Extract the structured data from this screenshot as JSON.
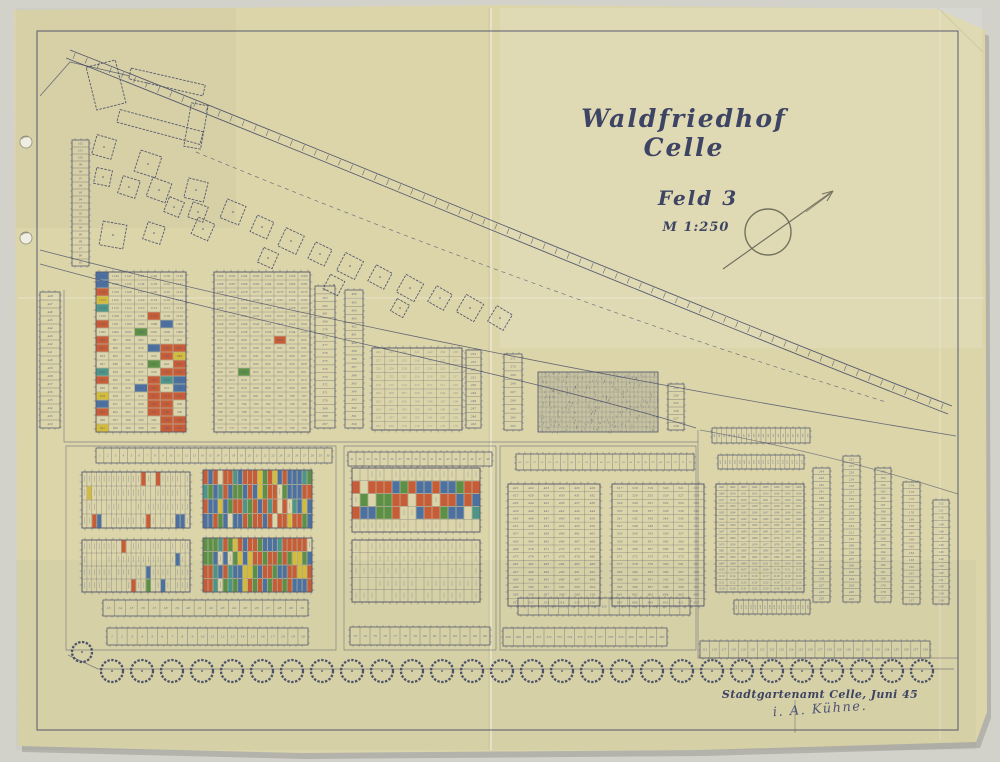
{
  "title_block": {
    "title": "Waldfriedhof Celle",
    "subtitle": "Feld 3",
    "scale": "M 1:250"
  },
  "stamp": {
    "office_line": "Stadtgartenamt Celle, Juni 45",
    "signature": "i. A. Kühne."
  },
  "colors": {
    "photo_bg": "#d2d2cb",
    "paper": "#dcd5aa",
    "ink": "#3e4463",
    "ink_light": "#555d82",
    "signature_ink": "#4e5576",
    "compass_ink": "#73725f",
    "plot_palette": [
      "#c4512c",
      "#3f68a0",
      "#4f8a3d",
      "#d1b832",
      "#3f8f86"
    ]
  },
  "north_arrow": {
    "cx": 768,
    "cy": 232,
    "r": 23
  },
  "map": {
    "roads": {
      "main_top": "M70,50 C350,160 650,288 952,406",
      "main_bot": "M66,58 C346,168 646,296 948,414",
      "dashed": "M196,152 C420,245 660,332 886,402",
      "curve1": "M40,250 C300,318 640,384 956,436",
      "curve2": "M40,264 C280,330 520,374 696,428",
      "spur": "M40,96 L70,62 L130,76",
      "fr_diag": "M700,430 C790,446 876,468 958,494"
    },
    "outlines": [
      "M64,290 V442 H698",
      "M66,446 H336 V650 H66 Z",
      "M344,446 H496 V650 H344 Z",
      "M500,446 H696 V650 H500 Z",
      "M698,430 V658 H958",
      "M795,700 V733"
    ],
    "buildings": {
      "bars": [
        [
          167,
          82,
          76,
          11,
          13
        ],
        [
          160,
          127,
          86,
          13,
          15
        ],
        [
          196,
          126,
          17,
          44,
          10
        ],
        [
          106,
          85,
          30,
          44,
          -14
        ]
      ],
      "squares": [
        [
          104,
          147,
          20,
          16
        ],
        [
          148,
          164,
          22,
          18
        ],
        [
          103,
          177,
          16,
          12
        ],
        [
          129,
          187,
          18,
          18
        ],
        [
          159,
          190,
          20,
          20
        ],
        [
          174,
          207,
          16,
          22
        ],
        [
          196,
          190,
          20,
          14
        ],
        [
          198,
          212,
          16,
          20
        ],
        [
          203,
          229,
          18,
          24
        ],
        [
          113,
          235,
          24,
          10
        ],
        [
          154,
          233,
          18,
          18
        ],
        [
          233,
          212,
          20,
          22
        ],
        [
          262,
          227,
          18,
          24
        ],
        [
          291,
          241,
          20,
          25
        ],
        [
          320,
          254,
          18,
          26
        ],
        [
          350,
          266,
          20,
          27
        ],
        [
          380,
          277,
          18,
          28
        ],
        [
          410,
          288,
          20,
          29
        ],
        [
          440,
          298,
          18,
          30
        ],
        [
          470,
          308,
          20,
          30
        ],
        [
          500,
          318,
          18,
          31
        ],
        [
          268,
          258,
          16,
          24
        ],
        [
          334,
          285,
          16,
          27
        ],
        [
          400,
          308,
          14,
          29
        ]
      ]
    },
    "strips": [
      {
        "id": "cluster-col",
        "x": 72,
        "y": 140,
        "len": 126,
        "cells": 18,
        "dir": "v",
        "w": 17,
        "start": 102,
        "step": -1,
        "fs": 2.6
      },
      {
        "id": "V1",
        "x": 40,
        "y": 292,
        "len": 136,
        "cells": 17,
        "dir": "v",
        "w": 20,
        "start": 448,
        "step": -1,
        "fs": 2.8
      },
      {
        "id": "V2",
        "x": 315,
        "y": 286,
        "len": 142,
        "cells": 18,
        "dir": "v",
        "w": 20,
        "start": 384,
        "step": -1,
        "fs": 2.8
      },
      {
        "id": "V3",
        "x": 345,
        "y": 290,
        "len": 138,
        "cells": 17,
        "dir": "v",
        "w": 18,
        "start": 406,
        "step": -1,
        "fs": 2.8
      },
      {
        "id": "V4",
        "x": 466,
        "y": 350,
        "len": 78,
        "cells": 10,
        "dir": "v",
        "w": 15,
        "start": 254,
        "step": -1,
        "fs": 2.8
      },
      {
        "id": "V5",
        "x": 504,
        "y": 354,
        "len": 76,
        "cells": 9,
        "dir": "v",
        "w": 18,
        "start": 271,
        "step": -1,
        "fs": 2.8
      },
      {
        "id": "V6",
        "x": 668,
        "y": 384,
        "len": 46,
        "cells": 6,
        "dir": "v",
        "w": 16,
        "start": 233,
        "step": 1,
        "fs": 2.8
      },
      {
        "id": "S1",
        "x": 813,
        "y": 468,
        "len": 134,
        "cells": 20,
        "dir": "v",
        "w": 17,
        "start": 244,
        "step": -1,
        "fs": 2.8
      },
      {
        "id": "S2",
        "x": 843,
        "y": 456,
        "len": 146,
        "cells": 22,
        "dir": "v",
        "w": 17,
        "start": 222,
        "step": -1,
        "fs": 2.8
      },
      {
        "id": "S3",
        "x": 875,
        "y": 468,
        "len": 134,
        "cells": 20,
        "dir": "v",
        "w": 16,
        "start": 196,
        "step": -1,
        "fs": 2.8
      },
      {
        "id": "S4",
        "x": 903,
        "y": 482,
        "len": 122,
        "cells": 18,
        "dir": "v",
        "w": 17,
        "start": 174,
        "step": -1,
        "fs": 2.8
      },
      {
        "id": "S5",
        "x": 933,
        "y": 500,
        "len": 104,
        "cells": 15,
        "dir": "v",
        "w": 16,
        "start": 152,
        "step": -1,
        "fs": 2.8
      },
      {
        "id": "L-top",
        "x": 96,
        "y": 448,
        "len": 236,
        "cells": 30,
        "dir": "h",
        "w": 15,
        "start": 1,
        "step": 1,
        "fs": 2.4
      },
      {
        "id": "M-top",
        "x": 348,
        "y": 452,
        "len": 144,
        "cells": 18,
        "dir": "h",
        "w": 14,
        "start": 31,
        "step": 1,
        "fs": 2.4
      },
      {
        "id": "R-top",
        "x": 516,
        "y": 454,
        "len": 178,
        "cells": 24,
        "dir": "h",
        "w": 16,
        "start": 49,
        "step": 1,
        "fs": 2.2
      },
      {
        "id": "FR-top1",
        "x": 712,
        "y": 428,
        "len": 98,
        "cells": 20,
        "dir": "h",
        "w": 15,
        "start": 481,
        "step": 1,
        "fs": 2.0,
        "rot": true
      },
      {
        "id": "FR-top2",
        "x": 718,
        "y": 455,
        "len": 86,
        "cells": 18,
        "dir": "h",
        "w": 14,
        "start": 461,
        "step": 1,
        "fs": 2.0,
        "rot": true
      },
      {
        "id": "FR-grid-bottom",
        "x": 734,
        "y": 600,
        "len": 76,
        "cells": 16,
        "dir": "h",
        "w": 14,
        "start": 441,
        "step": 1,
        "fs": 2.0,
        "rot": true
      },
      {
        "id": "BL1",
        "x": 103,
        "y": 600,
        "len": 205,
        "cells": 18,
        "dir": "h",
        "w": 16,
        "start": 13,
        "step": 1,
        "fs": 3
      },
      {
        "id": "BL2",
        "x": 107,
        "y": 628,
        "len": 201,
        "cells": 20,
        "dir": "h",
        "w": 17,
        "start": 1,
        "step": 1,
        "fs": 3
      },
      {
        "id": "BM",
        "x": 350,
        "y": 627,
        "len": 140,
        "cells": 14,
        "dir": "h",
        "w": 18,
        "start": 73,
        "step": 1,
        "fs": 3
      },
      {
        "id": "BR1",
        "x": 518,
        "y": 598,
        "len": 172,
        "cells": 17,
        "dir": "h",
        "w": 17,
        "start": 351,
        "step": 1,
        "fs": 2.6
      },
      {
        "id": "BR2",
        "x": 503,
        "y": 628,
        "len": 164,
        "cells": 16,
        "dir": "h",
        "w": 18,
        "start": 368,
        "step": 1,
        "fs": 2.6
      },
      {
        "id": "FR-bottom",
        "x": 700,
        "y": 641,
        "len": 230,
        "cells": 24,
        "dir": "h",
        "w": 17,
        "start": 115,
        "step": 1,
        "fs": 2.6
      }
    ],
    "blocks": [
      {
        "id": "A1",
        "x": 96,
        "y": 272,
        "w": 90,
        "h": 160,
        "cols": 7,
        "rows": 20,
        "fs": 2.7,
        "seed": 11,
        "segments": [
          {
            "from": 0,
            "count": 56,
            "start": 1144,
            "step": -1
          },
          {
            "from": 56,
            "count": 84,
            "start": 668,
            "step": -1
          }
        ],
        "coloring": {
          "mode": "leftcol_streak",
          "left_p": 0.8,
          "streak": [
            4,
            9,
            6,
            19
          ],
          "streak_p": 0.72,
          "sparse_p": 0.05
        }
      },
      {
        "id": "A2",
        "x": 214,
        "y": 272,
        "w": 96,
        "h": 160,
        "cols": 8,
        "rows": 20,
        "fs": 2.7,
        "seed": 21,
        "segments": [
          {
            "from": 0,
            "count": 64,
            "start": 1296,
            "step": -1
          },
          {
            "from": 64,
            "count": 96,
            "start": 860,
            "step": -1
          }
        ],
        "coloring": {
          "mode": "sparse",
          "p": 0.012
        }
      },
      {
        "id": "B",
        "x": 372,
        "y": 348,
        "w": 90,
        "h": 82,
        "cols": 7,
        "rows": 10,
        "fs": 2.7,
        "faint": true,
        "seed": 31,
        "segments": [
          {
            "from": 0,
            "count": 70,
            "start": 244,
            "step": -1
          }
        ],
        "coloring": {
          "mode": "none"
        }
      },
      {
        "id": "FR-grid",
        "x": 716,
        "y": 484,
        "w": 88,
        "h": 108,
        "cols": 8,
        "rows": 17,
        "fs": 2.4,
        "seed": 41,
        "segments": [
          {
            "from": 0,
            "count": 136,
            "start": 1001,
            "step": 1
          }
        ],
        "coloring": {
          "mode": "none"
        }
      },
      {
        "id": "R1",
        "x": 508,
        "y": 484,
        "w": 92,
        "h": 122,
        "cols": 6,
        "rows": 16,
        "fs": 2.9,
        "seed": 51,
        "segments": [
          {
            "from": 0,
            "count": 96,
            "start": 421,
            "step": 1
          }
        ],
        "coloring": {
          "mode": "none"
        }
      },
      {
        "id": "R2",
        "x": 612,
        "y": 484,
        "w": 92,
        "h": 122,
        "cols": 6,
        "rows": 16,
        "fs": 2.9,
        "seed": 61,
        "segments": [
          {
            "from": 0,
            "count": 96,
            "start": 517,
            "step": 1
          }
        ],
        "coloring": {
          "mode": "none"
        }
      },
      {
        "id": "L2a",
        "x": 82,
        "y": 472,
        "w": 108,
        "h": 56,
        "cols": 22,
        "rows": 4,
        "ticks": true,
        "seed": 71,
        "coloring": {
          "mode": "sparse",
          "p": 0.13
        }
      },
      {
        "id": "L2b",
        "x": 203,
        "y": 470,
        "w": 109,
        "h": 58,
        "cols": 22,
        "rows": 4,
        "ticks": true,
        "seed": 81,
        "coloring": {
          "mode": "mosaic",
          "p": 0.93
        }
      },
      {
        "id": "L3a",
        "x": 82,
        "y": 540,
        "w": 108,
        "h": 52,
        "cols": 22,
        "rows": 4,
        "ticks": true,
        "seed": 91,
        "coloring": {
          "mode": "sparse",
          "p": 0.07
        }
      },
      {
        "id": "L3b",
        "x": 203,
        "y": 538,
        "w": 109,
        "h": 54,
        "cols": 22,
        "rows": 4,
        "ticks": true,
        "seed": 101,
        "coloring": {
          "mode": "mosaic",
          "p": 0.9
        }
      },
      {
        "id": "M2",
        "x": 352,
        "y": 468,
        "w": 128,
        "h": 64,
        "cols": 16,
        "rows": 5,
        "ticks": true,
        "seed": 111,
        "coloring": {
          "mode": "mosaic",
          "p": 0.85,
          "rows": [
            1,
            3
          ]
        }
      },
      {
        "id": "M3",
        "x": 352,
        "y": 540,
        "w": 128,
        "h": 62,
        "cols": 16,
        "rows": 5,
        "ticks": true,
        "seed": 121,
        "coloring": {
          "mode": "none"
        }
      }
    ],
    "dense_block": {
      "x": 538,
      "y": 372,
      "w": 120,
      "h": 60,
      "cols": 30,
      "rows": 12,
      "seed": 131
    },
    "trees": {
      "first": {
        "cx": 82,
        "cy": 652,
        "r": 10
      },
      "row_y": 671,
      "x0": 112,
      "step": 30,
      "count": 28,
      "r": 11,
      "base": "M68,655 L98,669 L954,669"
    },
    "punch_holes": [
      [
        26,
        142
      ],
      [
        26,
        238
      ]
    ]
  }
}
